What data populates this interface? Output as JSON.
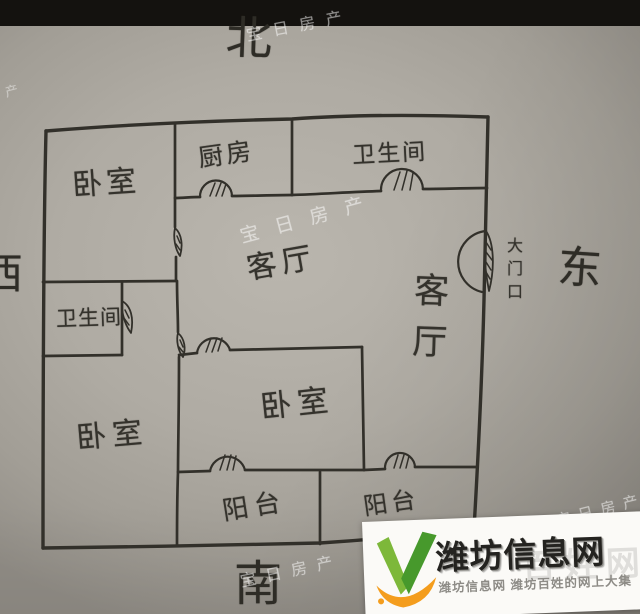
{
  "compass": {
    "north": "北",
    "east": "东",
    "south": "南",
    "west": "西"
  },
  "floorplan": {
    "rooms": [
      {
        "key": "bedroom-nw",
        "label": "卧室"
      },
      {
        "key": "kitchen",
        "label": "厨房"
      },
      {
        "key": "bathroom-north",
        "label": "卫生间"
      },
      {
        "key": "living-center",
        "label": "客厅"
      },
      {
        "key": "bathroom-west",
        "label": "卫生间"
      },
      {
        "key": "living-east",
        "label": "客厅"
      },
      {
        "key": "bedroom-sw",
        "label": "卧室"
      },
      {
        "key": "bedroom-center",
        "label": "卧室"
      },
      {
        "key": "balcony-left",
        "label": "阳台"
      },
      {
        "key": "balcony-right",
        "label": "阳台"
      }
    ],
    "entrance_label": "大门口",
    "ink_color": "#32302a"
  },
  "watermark": {
    "text": "宝日房产",
    "color": "#ffffff",
    "instances": [
      {
        "text": "宝日房产"
      },
      {
        "text": "宝日房产"
      },
      {
        "text": "宝日房产"
      },
      {
        "text": "宝日房产"
      },
      {
        "text": "产"
      }
    ]
  },
  "branding": {
    "site_name": "潍坊信息网",
    "tagline": "潍坊信息网 潍坊百姓的网上大集",
    "ghost_watermark": "百姓网",
    "colors": {
      "v_green_light": "#7db83a",
      "v_green_dark": "#47992c",
      "swoosh_orange": "#f49d1d",
      "title": "#242320",
      "tagline_gray": "#8d8b86"
    }
  }
}
